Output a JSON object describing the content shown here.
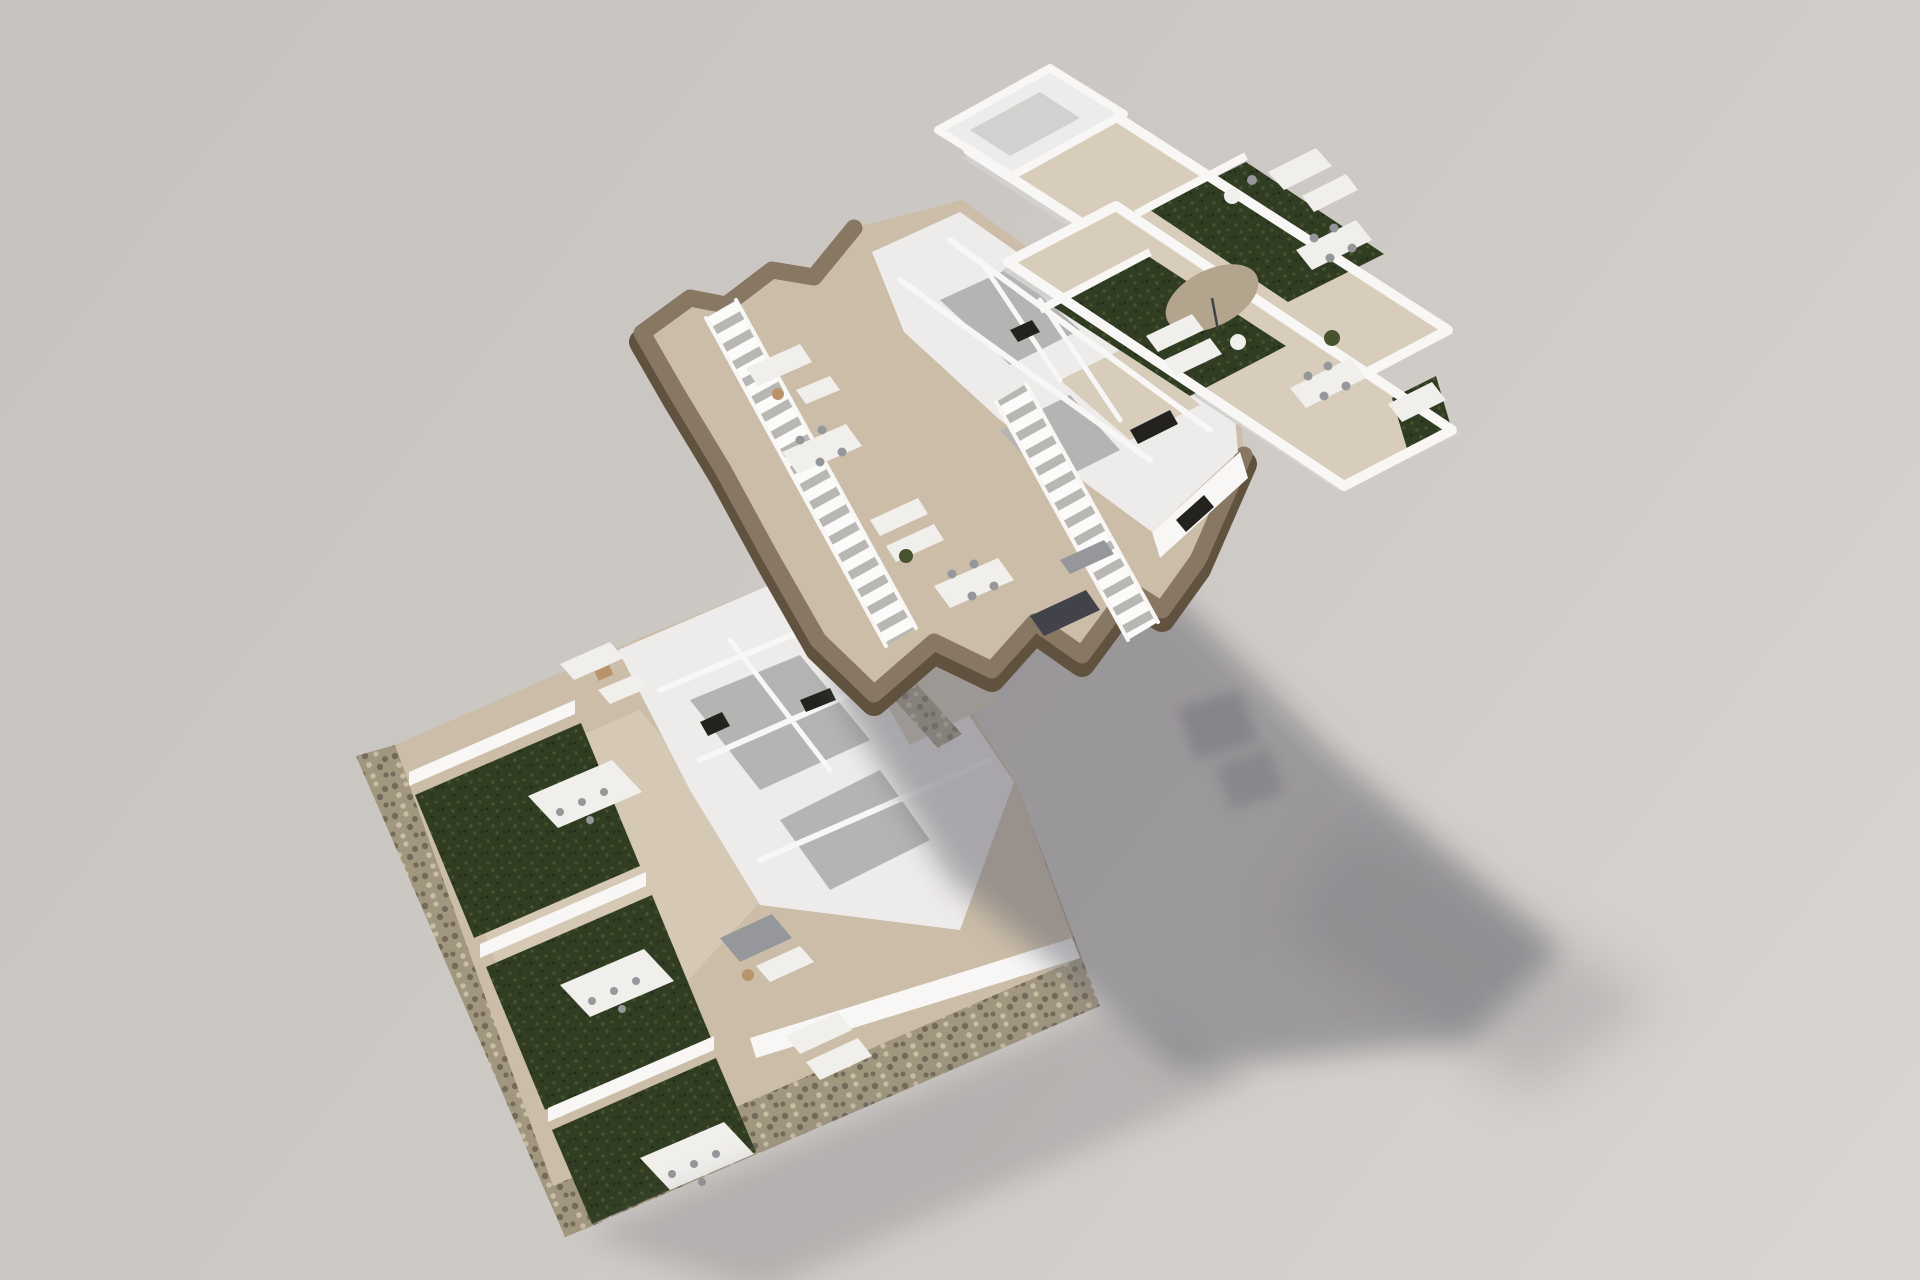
{
  "meta": {
    "title": "Exploded 3D axonometric floor-plan rendering of a residential building",
    "image_type": "architectural 3D visualization",
    "floors_shown": 3,
    "backdrop": "plain warm-grey studio background, sunlight from upper left, soft shadows cast to lower right"
  },
  "palette": {
    "bg": "#cdc9c5",
    "bgDark": "#c6c2be",
    "bgLight": "#d9d6d2",
    "shadow": "#706e76",
    "wallTop": "#f8f7f5",
    "wallLit": "#eeecea",
    "wallShade": "#d3d1cf",
    "wallDark": "#bdbbb9",
    "tile": "#cbbda8",
    "tileLight": "#d8cdbb",
    "floorGray": "#b6b4b3",
    "turfBase": "#313d23",
    "turfLight": "#46532c",
    "turfDark": "#232c18",
    "stoneBase": "#a1977f",
    "stoneDark": "#74695a",
    "stoneLight": "#c9bda6",
    "band": "#877763",
    "bandDark": "#60523f",
    "stepTread": "#fbfbfa",
    "stepGap": "#b9b7b4",
    "furnWhite": "#f1efec",
    "furnGray": "#96979a",
    "furnDark": "#41424a",
    "wood": "#b9946a",
    "parasol": "#b3a48d",
    "openingDark": "#23221f"
  },
  "scene": {
    "floors": [
      {
        "id": "ground-floor",
        "position": "bottom-left",
        "features": [
          "stone-clad plinth and perimeter garden walls",
          "three private gardens with artificial turf",
          "white garden divider walls",
          "pergola-covered outdoor dining sets",
          "outdoor sofa and lounger sets",
          "white-walled interior rooms with furniture",
          "exterior staircase at right side"
        ]
      },
      {
        "id": "upper-floor",
        "position": "center, floating (exploded view)",
        "features": [
          "white-walled apartment rooms",
          "organic curved walkway with brown timber fascia",
          "two long exterior staircases",
          "tiled terraces with dining tables, sun loungers and sofas",
          "large soft shadow cast on backdrop below"
        ]
      },
      {
        "id": "roof-terrace",
        "position": "top-right",
        "features": [
          "two parallel roof-terrace strips",
          "white parapet walls",
          "artificial turf patches",
          "tiled deck areas",
          "outdoor lounge and dining furniture",
          "sun parasol",
          "sun loungers",
          "potted plants"
        ]
      }
    ],
    "lighting": {
      "sun_direction": "upper-left",
      "shadow_direction": "lower-right"
    }
  }
}
